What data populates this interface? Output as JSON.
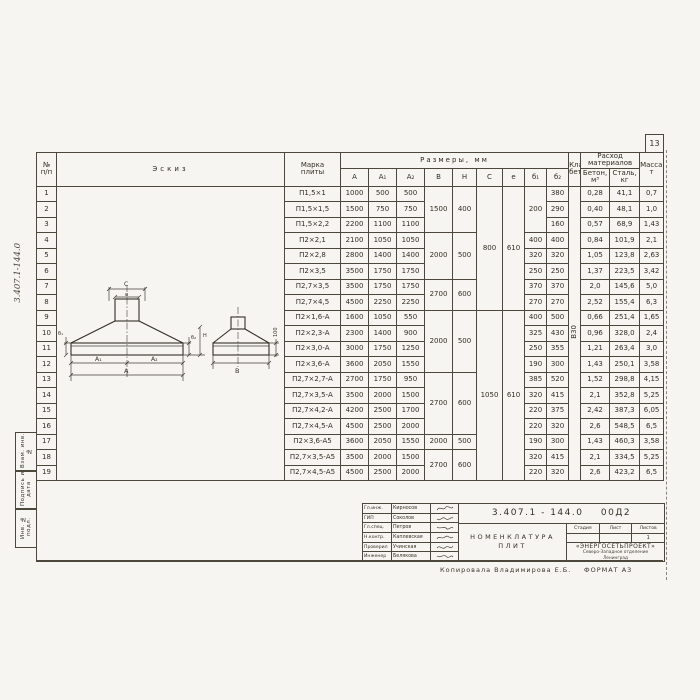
{
  "page": {
    "number": "13",
    "copy_note": "Копировала  Владимирова Е.Б.",
    "format_note": "ФОРМАТ А3",
    "margin_doc_number": "3.407.1-144.0",
    "margin_stamps": [
      "Взам. инв. №",
      "Подпись и дата",
      "Инв. № подл."
    ]
  },
  "table": {
    "headers": {
      "n1": "№",
      "n2": "п/п",
      "sketch": "Эскиз",
      "mark1": "Марка",
      "mark2": "плиты",
      "dims": "Размеры, мм",
      "dim_cols": [
        "А",
        "А₁",
        "А₂",
        "В",
        "Н",
        "С",
        "е",
        "б₁",
        "б₂"
      ],
      "class1": "Класс",
      "class2": "бетона",
      "consumption1": "Расход",
      "consumption2": "материалов",
      "concrete1": "Бетон,",
      "concrete2": "м³",
      "steel1": "Сталь,",
      "steel2": "кг",
      "mass1": "Масса,",
      "mass2": "т"
    },
    "concrete_class": "В30",
    "merged": {
      "b1": "200",
      "c1": "800",
      "c2": "1050",
      "e1": "610",
      "e2": "610",
      "bh": [
        {
          "b": "1500",
          "h": "400"
        },
        {
          "b": "2000",
          "h": "500"
        },
        {
          "b": "2700",
          "h": "600"
        },
        {
          "b": "2000",
          "h": "500"
        },
        {
          "b": "2700",
          "h": "600"
        },
        {
          "b": "2000",
          "h": "500"
        },
        {
          "b": "2700",
          "h": "600"
        }
      ]
    },
    "rows": [
      {
        "n": "1",
        "mark": "П1,5×1",
        "a": "1000",
        "a1": "500",
        "a2": "500",
        "b2": "380",
        "bet": "0,28",
        "st": "41,1",
        "m": "0,7"
      },
      {
        "n": "2",
        "mark": "П1,5×1,5",
        "a": "1500",
        "a1": "750",
        "a2": "750",
        "b2": "290",
        "bet": "0,40",
        "st": "48,1",
        "m": "1,0"
      },
      {
        "n": "3",
        "mark": "П1,5×2,2",
        "a": "2200",
        "a1": "1100",
        "a2": "1100",
        "b2": "160",
        "bet": "0,57",
        "st": "68,9",
        "m": "1,43"
      },
      {
        "n": "4",
        "mark": "П2×2,1",
        "a": "2100",
        "a1": "1050",
        "a2": "1050",
        "b1": "400",
        "b2": "400",
        "bet": "0,84",
        "st": "101,9",
        "m": "2,1"
      },
      {
        "n": "5",
        "mark": "П2×2,8",
        "a": "2800",
        "a1": "1400",
        "a2": "1400",
        "b1": "320",
        "b2": "320",
        "bet": "1,05",
        "st": "123,8",
        "m": "2,63"
      },
      {
        "n": "6",
        "mark": "П2×3,5",
        "a": "3500",
        "a1": "1750",
        "a2": "1750",
        "b1": "250",
        "b2": "250",
        "bet": "1,37",
        "st": "223,5",
        "m": "3,42"
      },
      {
        "n": "7",
        "mark": "П2,7×3,5",
        "a": "3500",
        "a1": "1750",
        "a2": "1750",
        "b1": "370",
        "b2": "370",
        "bet": "2,0",
        "st": "145,6",
        "m": "5,0"
      },
      {
        "n": "8",
        "mark": "П2,7×4,5",
        "a": "4500",
        "a1": "2250",
        "a2": "2250",
        "b1": "270",
        "b2": "270",
        "bet": "2,52",
        "st": "155,4",
        "m": "6,3"
      },
      {
        "n": "9",
        "mark": "П2×1,6-А",
        "a": "1600",
        "a1": "1050",
        "a2": "550",
        "b1": "400",
        "b2": "500",
        "bet": "0,66",
        "st": "251,4",
        "m": "1,65"
      },
      {
        "n": "10",
        "mark": "П2×2,3-А",
        "a": "2300",
        "a1": "1400",
        "a2": "900",
        "b1": "325",
        "b2": "430",
        "bet": "0,96",
        "st": "328,0",
        "m": "2,4"
      },
      {
        "n": "11",
        "mark": "П2×3,0-А",
        "a": "3000",
        "a1": "1750",
        "a2": "1250",
        "b1": "250",
        "b2": "355",
        "bet": "1,21",
        "st": "263,4",
        "m": "3,0"
      },
      {
        "n": "12",
        "mark": "П2×3,6-А",
        "a": "3600",
        "a1": "2050",
        "a2": "1550",
        "b1": "190",
        "b2": "300",
        "bet": "1,43",
        "st": "250,1",
        "m": "3,58"
      },
      {
        "n": "13",
        "mark": "П2,7×2,7-А",
        "a": "2700",
        "a1": "1750",
        "a2": "950",
        "b1": "385",
        "b2": "520",
        "bet": "1,52",
        "st": "298,8",
        "m": "4,15"
      },
      {
        "n": "14",
        "mark": "П2,7×3,5-А",
        "a": "3500",
        "a1": "2000",
        "a2": "1500",
        "b1": "320",
        "b2": "415",
        "bet": "2,1",
        "st": "352,8",
        "m": "5,25"
      },
      {
        "n": "15",
        "mark": "П2,7×4,2-А",
        "a": "4200",
        "a1": "2500",
        "a2": "1700",
        "b1": "220",
        "b2": "375",
        "bet": "2,42",
        "st": "387,3",
        "m": "6,05"
      },
      {
        "n": "16",
        "mark": "П2,7×4,5-А",
        "a": "4500",
        "a1": "2500",
        "a2": "2000",
        "b1": "220",
        "b2": "320",
        "bet": "2,6",
        "st": "548,5",
        "m": "6,5"
      },
      {
        "n": "17",
        "mark": "П2×3,6-А5",
        "a": "3600",
        "a1": "2050",
        "a2": "1550",
        "b1": "190",
        "b2": "300",
        "bet": "1,43",
        "st": "460,3",
        "m": "3,58"
      },
      {
        "n": "18",
        "mark": "П2,7×3,5-А5",
        "a": "3500",
        "a1": "2000",
        "a2": "1500",
        "b1": "320",
        "b2": "415",
        "bet": "2,1",
        "st": "334,5",
        "m": "5,25"
      },
      {
        "n": "19",
        "mark": "П2,7×4,5-А5",
        "a": "4500",
        "a1": "2500",
        "a2": "2000",
        "b1": "220",
        "b2": "320",
        "bet": "2,6",
        "st": "423,2",
        "m": "6,5"
      }
    ]
  },
  "sketch": {
    "labels": {
      "c": "C",
      "e": "e",
      "b2": "б₂",
      "h": "Н",
      "b1": "б₁",
      "a1": "А₁",
      "a2": "А₂",
      "a": "А",
      "b": "В",
      "note": "100"
    }
  },
  "title_block": {
    "doc_number": "3.407.1 - 144.0    00Д2",
    "title_line1": "НОМЕНКЛАТУРА",
    "title_line2": "ПЛИТ",
    "stage_label": "Стадия",
    "sheet_label": "Лист",
    "sheets_label": "Листов",
    "stage_value": "",
    "sheet_value": "",
    "sheets_value": "1",
    "org_line1": "«ЭНЕРГОСЕТЬПРОЕКТ»",
    "org_line2": "Северо-Западное отделение",
    "org_line3": "Ленинград",
    "signatures": [
      {
        "role": "Гл.инж.",
        "name": "Кирносов"
      },
      {
        "role": "ГИП",
        "name": "Соколов"
      },
      {
        "role": "Гл.спец.",
        "name": "Петров"
      },
      {
        "role": "Н.контр.",
        "name": "Каплевская"
      },
      {
        "role": "Проверил",
        "name": "Учинская"
      },
      {
        "role": "Инженер",
        "name": "Белякова"
      }
    ]
  }
}
